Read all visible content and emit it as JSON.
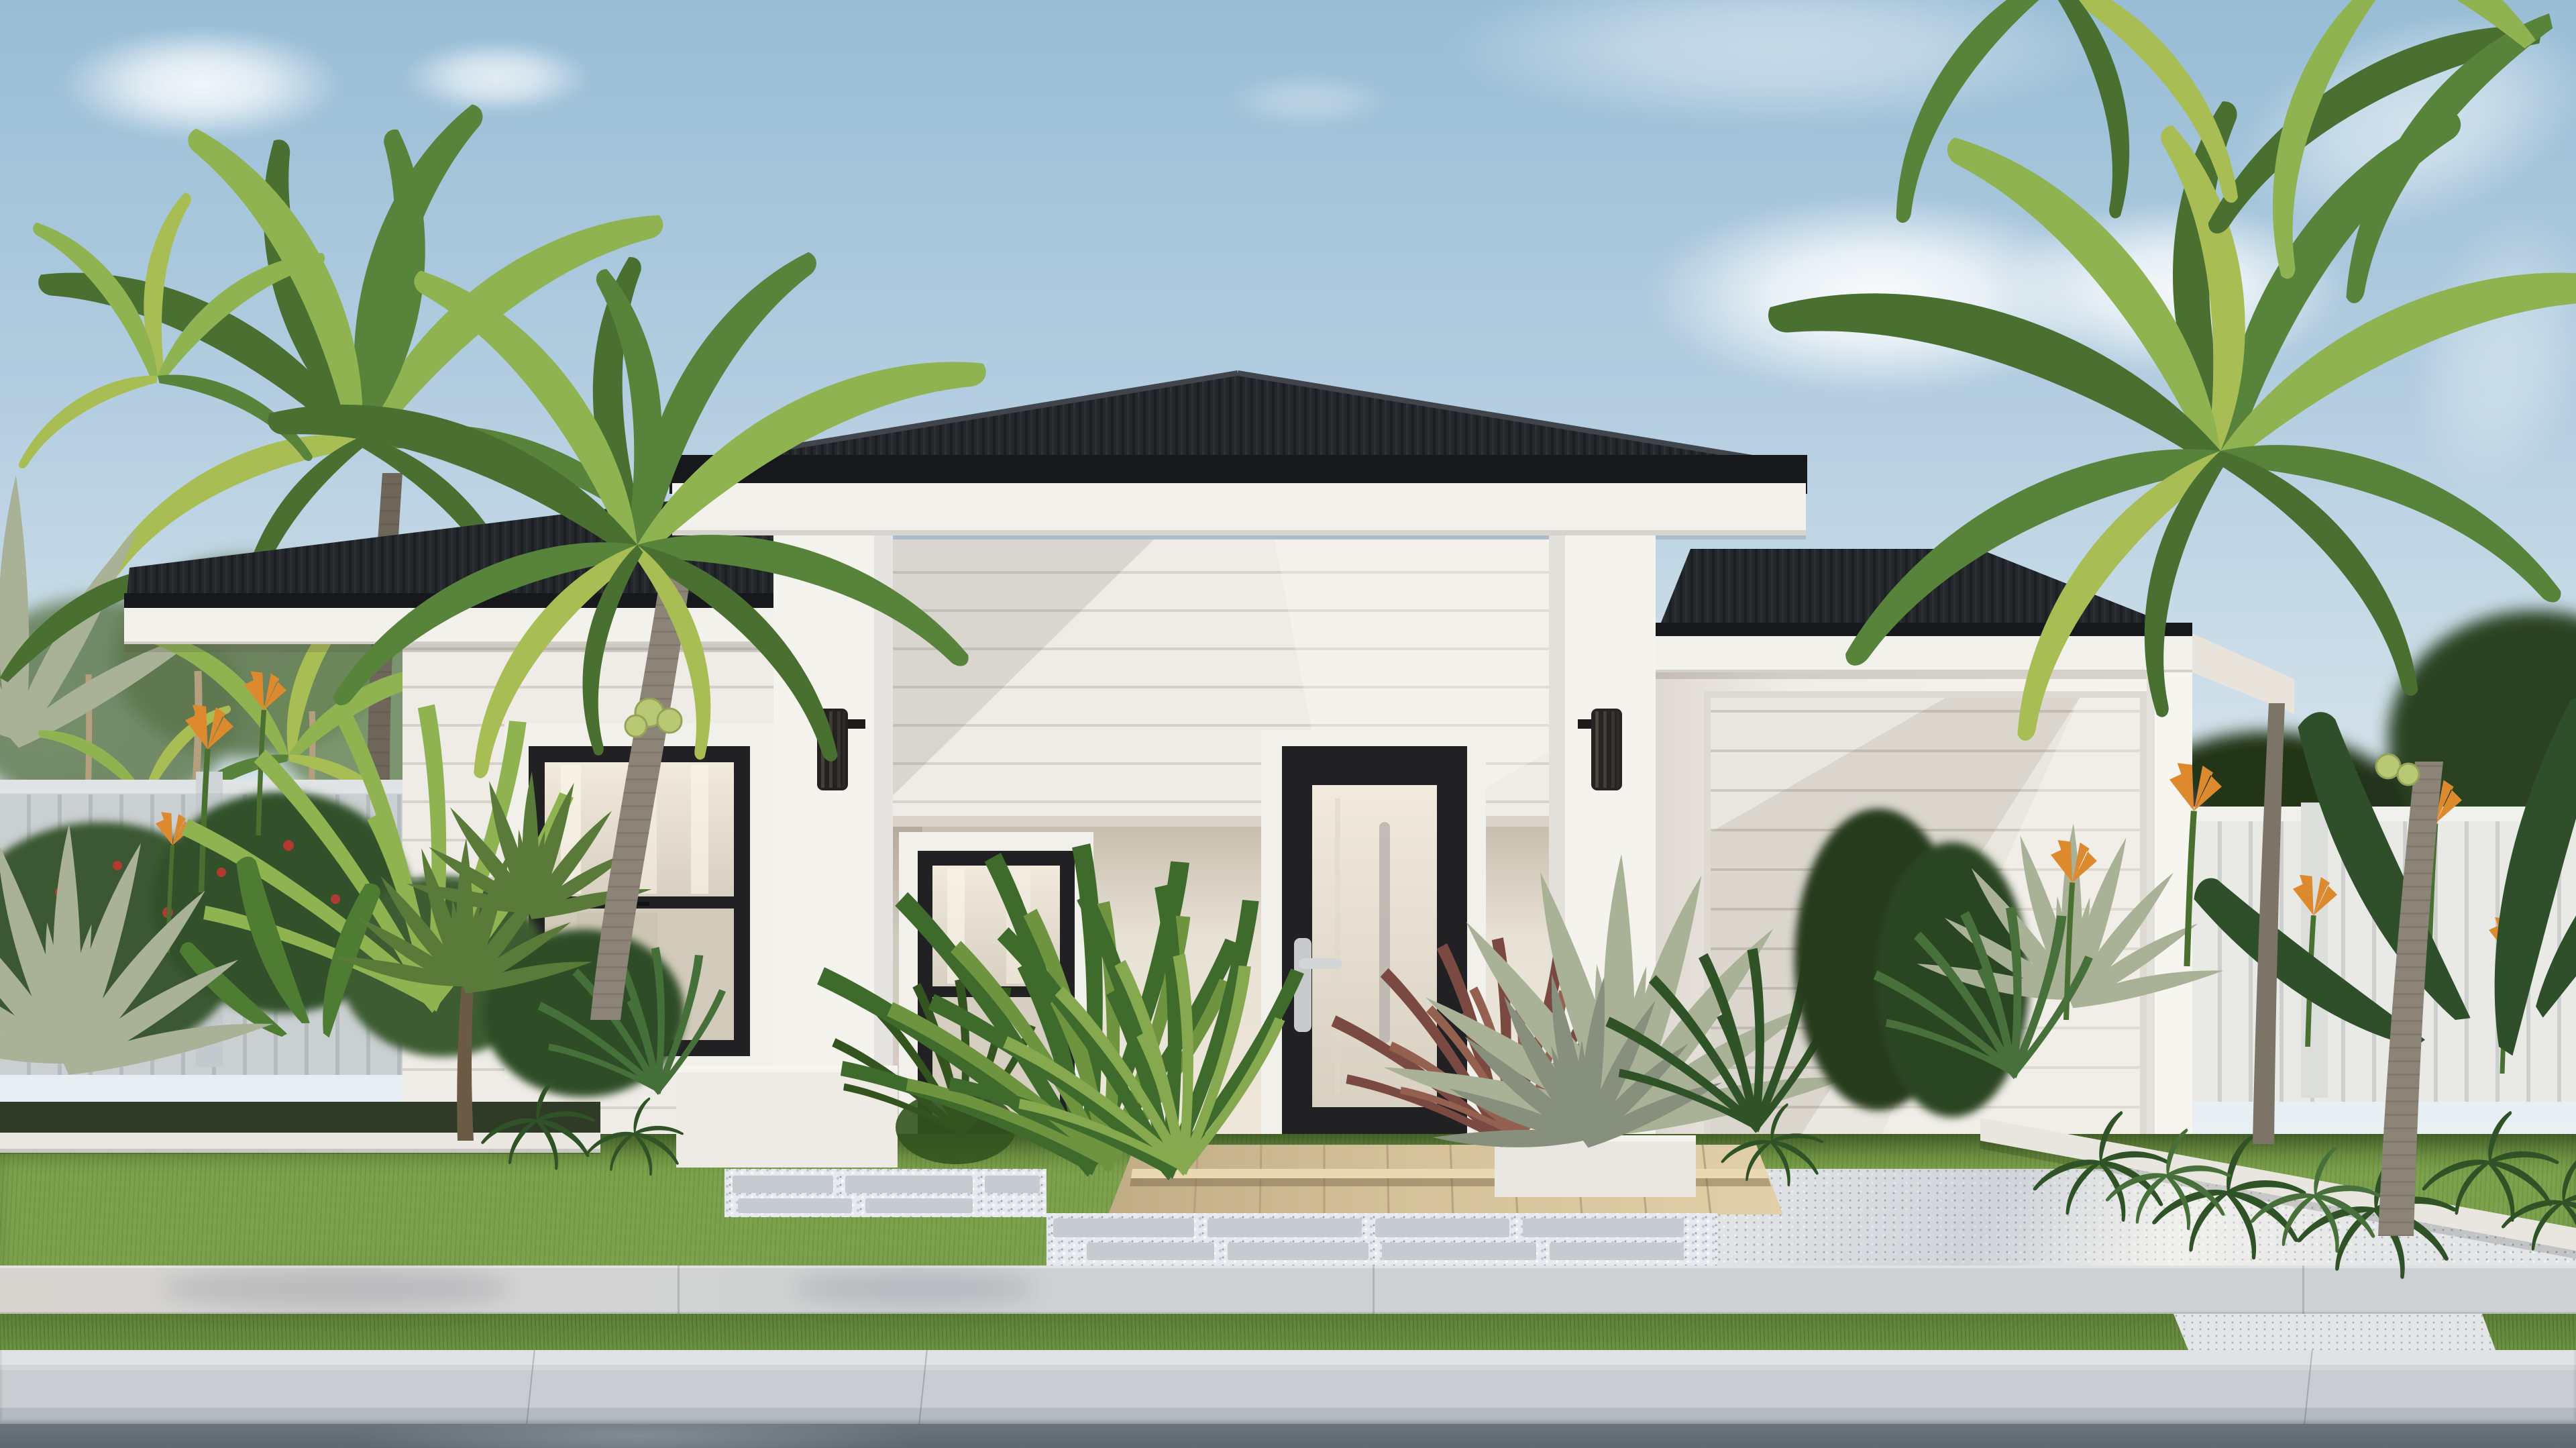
{
  "scene": {
    "kind": "architectural-exterior-render",
    "subject": "single-storey coastal style house with black hip roofs, white weatherboard portico, front garden, driveway and street verge",
    "time_of_day": "daytime, sunny with scattered clouds",
    "camera": "street front elevation"
  },
  "palette": {
    "sky-top": "#98bdd6",
    "sky-mid": "#b2cde0",
    "sky-low": "#cfdfe9",
    "cloud": "#ffffff",
    "roof": "#23262a",
    "roof-rib-light": "#41454b",
    "gutter": "#16181b",
    "fascia": "#f3f1ec",
    "siding": "#efece7",
    "siding-line": "#d6d2ca",
    "render-wall": "#f0ede8",
    "render-wall-shade": "#ded9d1",
    "pillar": "#f5f3ee",
    "porch-wall": "#e8e1d5",
    "porch-shade": "#c8bfae",
    "frame-black": "#212123",
    "glass-warm": "#f1eadd",
    "glass-dim": "#d8d0c1",
    "trim-white": "#f2f0ea",
    "handle-silver": "#c7c9ca",
    "garage-door": "#eae7e0",
    "garage-door-line": "#cec9bf",
    "fence-board": "#d6dadb",
    "fence-gap": "#bec5c8",
    "fence-board-sun": "#e9e9e6",
    "lawn": "#7da24d",
    "lawn-shade": "#6a8f40",
    "verge": "#6d9242",
    "sidewalk": "#ced1d3",
    "curb-top": "#e0e3e5",
    "curb-face": "#c9cdd1",
    "road": "#6b737c",
    "driveway": "#e3e5e7",
    "driveway-speckle": "#a9b0b8",
    "tile-tan": "#d5c29b",
    "tile-grout": "#b19d77",
    "paver": "#c6cbd0",
    "pebble": "#e6eaee",
    "trunk": "#8d8478",
    "trunk-shade": "#6e665a",
    "leaf-dark": "#4a7031",
    "leaf-mid": "#57833a",
    "leaf-light": "#8fb351",
    "leaf-yellow": "#a9bd55",
    "hedge-dark": "#233619",
    "bush-green": "#3a5830",
    "agave-silver": "#a9b197",
    "agave-shade": "#86907c",
    "flower-orange": "#dd8a2f",
    "flower-red": "#b23a30",
    "jacaranda-purple": "#8d7cb4",
    "soil-dark": "#2f3b27",
    "bed-wall-white": "#ebe8e1"
  },
  "house": {
    "storeys": 1,
    "roof": {
      "style": "hip",
      "material": "corrugated metal",
      "color_key": "roof",
      "sections": [
        "left wing",
        "central portico tower",
        "garage wing"
      ]
    },
    "portico": {
      "pillars": 2,
      "wall_cladding": "horizontal weatherboard",
      "sconce_lights": 2,
      "sconce_style": "black ribbed cylinder up/down light"
    },
    "front_door": {
      "frame": "black",
      "panel": "full-height frosted glass",
      "handle": "silver lever, left side",
      "interior_pull": "vertical silver bar seen through glass"
    },
    "windows": [
      {
        "name": "left-wing-window",
        "type": "double-hung",
        "frame": "black",
        "trim": "white",
        "curtains": true
      },
      {
        "name": "porch-window",
        "type": "double-hung",
        "frame": "black",
        "trim": "white",
        "curtains": true
      }
    ],
    "garage": {
      "door_style": "flat horizontal-line panel door",
      "door_color_key": "garage-door",
      "panel_lines": 12
    }
  },
  "landscape": {
    "fences": [
      {
        "name": "left-fence",
        "style": "vertical slat",
        "color_key": "fence-board"
      },
      {
        "name": "right-fence",
        "style": "vertical slat",
        "color_key": "fence-board-sun"
      }
    ],
    "palms": {
      "count": 6,
      "types": [
        "coconut palm left",
        "tall palm top-left",
        "silver fan palm far-left",
        "golden cane cluster",
        "coconut palm right",
        "corner palms top-right"
      ],
      "coconut_clusters": 2
    },
    "background_trees": [
      "eucalyptus gums left",
      "dense dark canopy right",
      "purple flowering jacaranda right"
    ],
    "garden_plants": [
      "silver agave",
      "spike grass clumps",
      "heliconia with orange flowers",
      "red flowering shrubs",
      "yucca heads",
      "bird of paradise leaves",
      "ferns",
      "red cordyline"
    ],
    "beds": {
      "edging": "white rendered planter walls",
      "count": 4
    }
  },
  "ground": {
    "front_path": {
      "porch_tiles": "tan square tiles with two steps",
      "pavers": "grey rectangular pavers set in white pebbles"
    },
    "lawn": "mown green lawn",
    "driveway": "white exposed-aggregate concrete",
    "street": [
      "concrete sidewalk",
      "grass verge",
      "concrete curb",
      "asphalt road"
    ]
  }
}
